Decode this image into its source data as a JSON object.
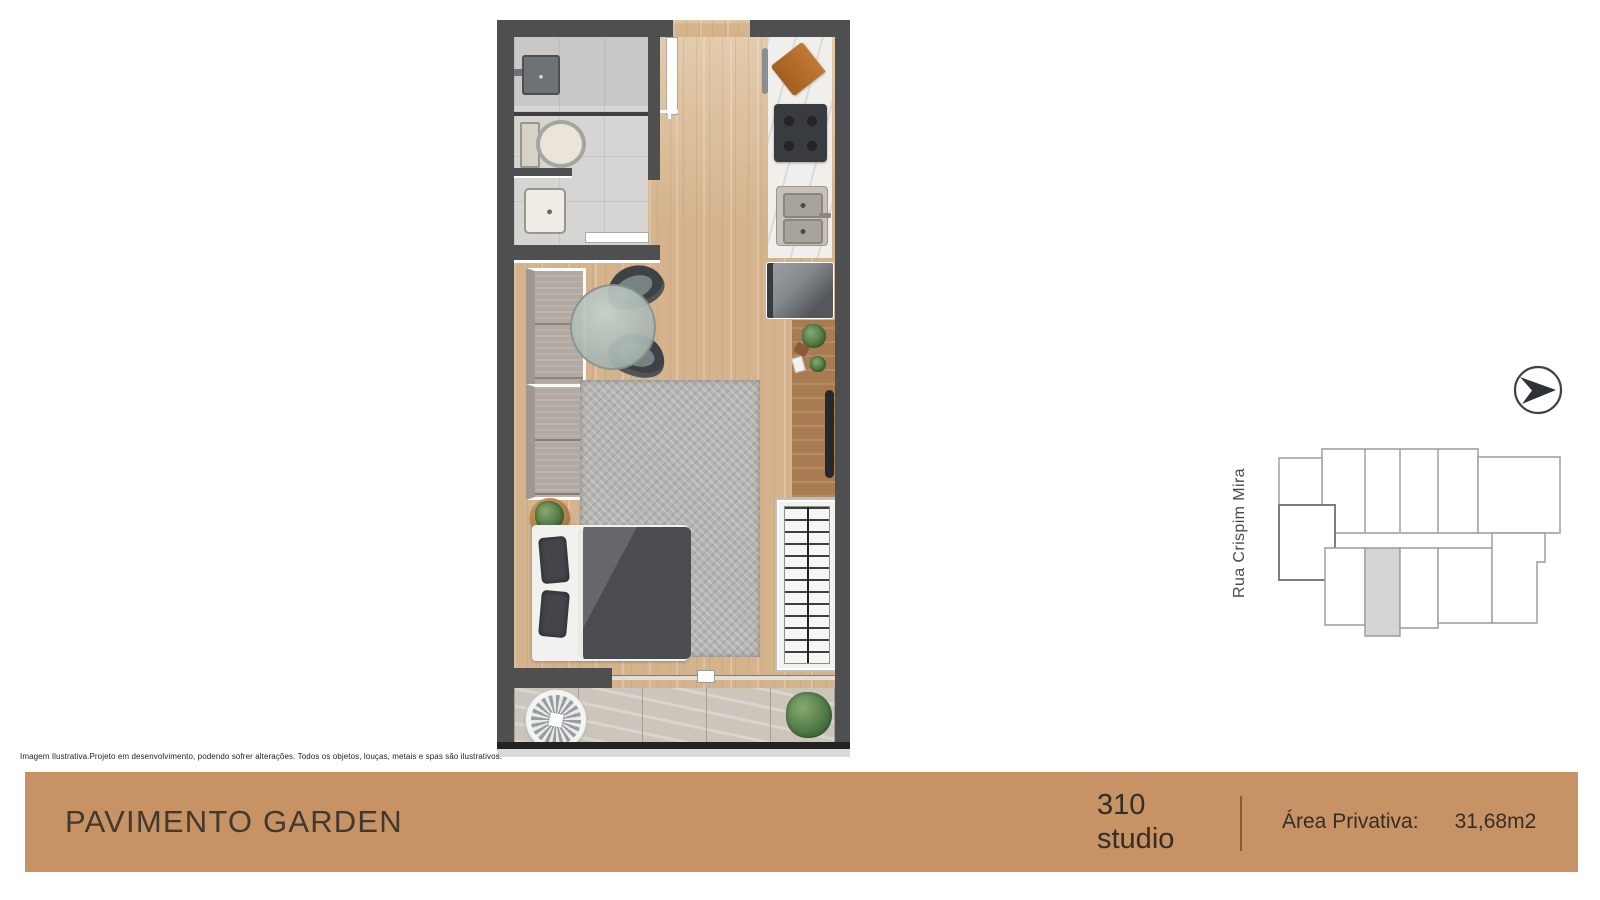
{
  "theme": {
    "wall": "#4e4f51",
    "wood": "#d5b48d",
    "tile": "#d6d5d3",
    "tile_dark": "#c9c8c6",
    "marble": "#f0efec",
    "rug": "#b7b5b2",
    "sofa": "#b2a9a2",
    "dark_furniture": "#3e4246",
    "duvet": "#55565b",
    "balcony_tile": "#ccc5bc",
    "desk_wood": "#a87c50",
    "bar": "#c79264",
    "bar_text": "#3a332c",
    "keyplan_stroke": "#9a9a9a",
    "keyplan_highlight": "#d5d5d5"
  },
  "disclaimer": "Imagem Ilustrativa.Projeto em desenvolvimento, podendo sofrer alterações. Todos os objetos, louças, metais e spas são ilustrativos.",
  "footer": {
    "title": "PAVIMENTO GARDEN",
    "unit_number": "310",
    "unit_type": "studio",
    "area_label": "Área Privativa:",
    "area_value": "31,68m2"
  },
  "keyplan": {
    "street_label": "Rua Crispim Mira"
  },
  "compass": {
    "icon": "arrow-in-circle"
  }
}
